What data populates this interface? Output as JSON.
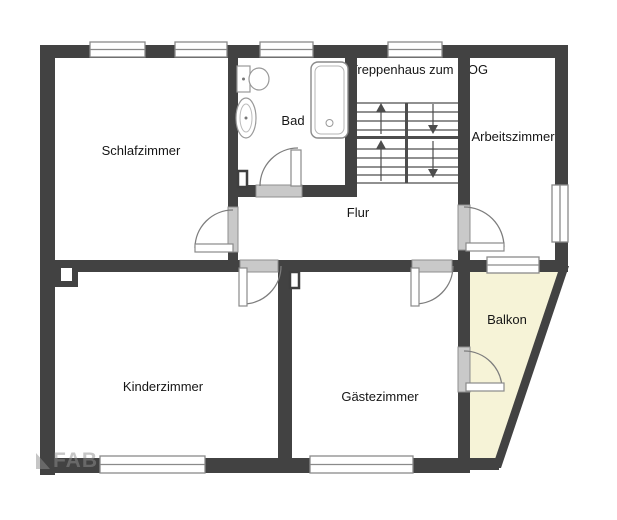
{
  "floorplan": {
    "type": "floor-plan",
    "labels": {
      "schlafzimmer": "Schlafzimmer",
      "bad": "Bad",
      "treppenhaus": "Treppenhaus zum 1.OG",
      "arbeitszimmer": "Arbeitszimmer",
      "flur": "Flur",
      "kinderzimmer": "Kinderzimmer",
      "gaestezimmer": "Gästezimmer",
      "balkon": "Balkon"
    },
    "colors": {
      "wall": "#424242",
      "balcony_fill": "#f6f3d7",
      "door_panel": "#c9c9c9",
      "outline": "#8a8a8a",
      "label_text": "#161616",
      "background": "#ffffff"
    },
    "watermark": {
      "text": "FAB"
    },
    "icons": {
      "bathtub": "bathtub-icon",
      "toilet": "toilet-icon",
      "sink": "sink-icon",
      "stairs_up": "arrow-up-icon",
      "stairs_down": "arrow-down-icon",
      "chimney": "chimney-icon"
    }
  }
}
